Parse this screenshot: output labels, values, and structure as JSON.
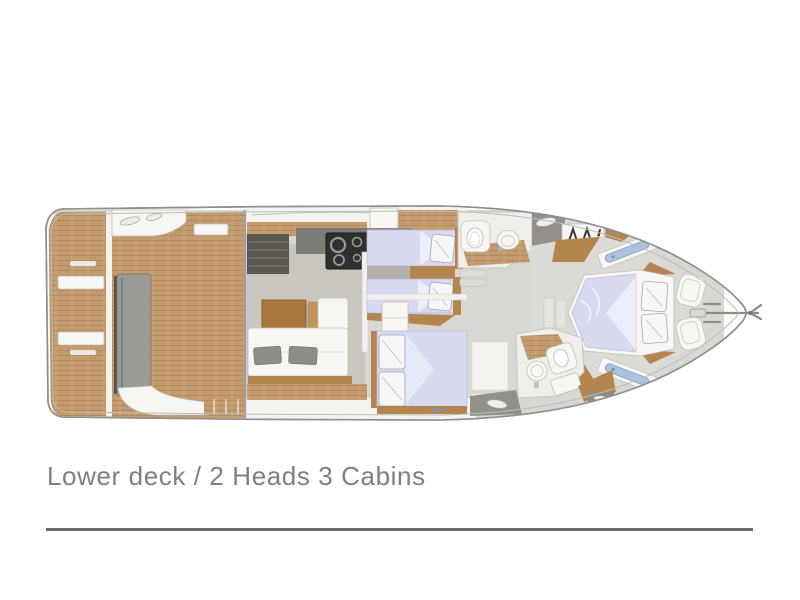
{
  "caption": {
    "text": "Lower deck / 2 Heads 3 Cabins"
  },
  "plan": {
    "type": "yacht-deck-floorplan",
    "orientation": "bow-right",
    "deck": "Lower deck",
    "counts": {
      "heads": 2,
      "cabins": 3
    },
    "areas": [
      "swim-platform",
      "cockpit",
      "saloon",
      "galley",
      "flybridge-stairs",
      "twin-guest-cabin",
      "vip-cabin",
      "guest-head",
      "master-head",
      "wardrobe",
      "master-cabin",
      "bow-lockers",
      "anchor-roller"
    ],
    "icons": [
      "stove-icon",
      "toilet-icon",
      "sink-icon",
      "hanger-icon",
      "deck-hatch",
      "hull-window",
      "anchor-roller-icon"
    ]
  },
  "colors": {
    "teak": "#c49b6d",
    "teakLine": "#a9825a",
    "teakLight": "#d9bc92",
    "wood": "#b5854f",
    "woodDark": "#96682f",
    "floor": "#d9d7d1",
    "salonFloor": "#c9c6bf",
    "gray": "#9b9b96",
    "charcoal": "#2f2f2d",
    "bedding": "#d7daf0",
    "windowBlue": "#a8c4e0",
    "outline": "#8f8f8d",
    "captionColor": "#7f7f7f",
    "ruleColor": "#6a6a6a"
  }
}
